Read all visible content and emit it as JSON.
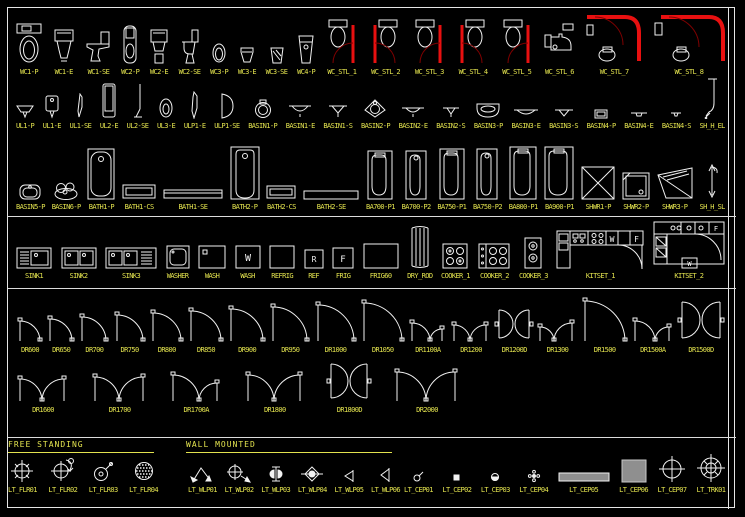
{
  "palette": {
    "background": "#000000",
    "line_color": "#f2f2f2",
    "label_color": "#e2e24e",
    "red": "#e81010",
    "dark_red": "#7e0000",
    "gray_fill": "#8f8f8f"
  },
  "sections": {
    "free_standing": "FREE STANDING",
    "wall_mounted": "WALL MOUNTED"
  },
  "glyph_letters": {
    "w": "W",
    "f": "F",
    "r": "R"
  },
  "rows": [
    {
      "id": "wc",
      "items": [
        {
          "label": "WC1-P",
          "glyph": "wc_p"
        },
        {
          "label": "WC1-E",
          "glyph": "wc_e"
        },
        {
          "label": "WC1-SE",
          "glyph": "wc_se"
        },
        {
          "label": "WC2-P",
          "glyph": "wc2_p"
        },
        {
          "label": "WC2-E",
          "glyph": "wc2_e"
        },
        {
          "label": "WC2-SE",
          "glyph": "wc2_se"
        },
        {
          "label": "WC3-P",
          "glyph": "wc3_p"
        },
        {
          "label": "WC3-E",
          "glyph": "wc3_e"
        },
        {
          "label": "WC3-SE",
          "glyph": "wc3_se"
        },
        {
          "label": "WC4-P",
          "glyph": "wc4_p"
        },
        {
          "label": "WC_STL_1",
          "glyph": "stl",
          "p": [
            0
          ]
        },
        {
          "label": "WC_STL_2",
          "glyph": "stl",
          "p": [
            1
          ]
        },
        {
          "label": "WC_STL_3",
          "glyph": "stl",
          "p": [
            0
          ]
        },
        {
          "label": "WC_STL_4",
          "glyph": "stl",
          "p": [
            1
          ]
        },
        {
          "label": "WC_STL_5",
          "glyph": "stl",
          "p": [
            0
          ]
        },
        {
          "label": "WC_STL_6",
          "glyph": "stl6"
        },
        {
          "label": "WC_STL_7",
          "glyph": "stl7"
        },
        {
          "label": "WC_STL_8",
          "glyph": "stl8"
        }
      ]
    },
    {
      "id": "urinal-basin",
      "items": [
        {
          "label": "UL1-P",
          "glyph": "ul1p"
        },
        {
          "label": "UL1-E",
          "glyph": "ul1e"
        },
        {
          "label": "UL1-SE",
          "glyph": "ul1se"
        },
        {
          "label": "UL2-E",
          "glyph": "ul2e"
        },
        {
          "label": "UL2-SE",
          "glyph": "ul2se"
        },
        {
          "label": "UL3-E",
          "glyph": "ul3e"
        },
        {
          "label": "ULP1-E",
          "glyph": "ulp1e"
        },
        {
          "label": "ULP1-SE",
          "glyph": "ulp1se"
        },
        {
          "label": "BASIN1-P",
          "glyph": "bs1p"
        },
        {
          "label": "BASIN1-E",
          "glyph": "bs1e"
        },
        {
          "label": "BASIN1-S",
          "glyph": "bs1s"
        },
        {
          "label": "BASIN2-P",
          "glyph": "bs2p"
        },
        {
          "label": "BASIN2-E",
          "glyph": "bs2e"
        },
        {
          "label": "BASIN2-S",
          "glyph": "bs2s"
        },
        {
          "label": "BASIN3-P",
          "glyph": "bs3p"
        },
        {
          "label": "BASIN3-E",
          "glyph": "bs3e"
        },
        {
          "label": "BASIN3-S",
          "glyph": "bs3s"
        },
        {
          "label": "BASIN4-P",
          "glyph": "bs4p"
        },
        {
          "label": "BASIN4-E",
          "glyph": "bs4e"
        },
        {
          "label": "BASIN4-S",
          "glyph": "bs4s"
        },
        {
          "label": "SH_H_EL",
          "glyph": "shhel"
        }
      ]
    },
    {
      "id": "bath",
      "items": [
        {
          "label": "BASIN5-P",
          "glyph": "bs5p"
        },
        {
          "label": "BASIN6-P",
          "glyph": "bs6p"
        },
        {
          "label": "BATH1-P",
          "glyph": "bath1p"
        },
        {
          "label": "BATH1-CS",
          "glyph": "bath1cs"
        },
        {
          "label": "BATH1-SE",
          "glyph": "bath1se"
        },
        {
          "label": "BATH2-P",
          "glyph": "bath2p"
        },
        {
          "label": "BATH2-CS",
          "glyph": "bath2cs"
        },
        {
          "label": "BATH2-SE",
          "glyph": "bath2se"
        },
        {
          "label": "BA700-P1",
          "glyph": "bav",
          "p": [
            26,
            50,
            1
          ]
        },
        {
          "label": "BA700-P2",
          "glyph": "bav",
          "p": [
            22,
            50,
            0
          ]
        },
        {
          "label": "BA750-P1",
          "glyph": "bav",
          "p": [
            26,
            52,
            1
          ]
        },
        {
          "label": "BA750-P2",
          "glyph": "bav",
          "p": [
            22,
            52,
            0
          ]
        },
        {
          "label": "BA800-P1",
          "glyph": "bav",
          "p": [
            28,
            54,
            1
          ]
        },
        {
          "label": "BA900-P1",
          "glyph": "bav",
          "p": [
            30,
            54,
            1
          ]
        },
        {
          "label": "SHWR1-P",
          "glyph": "shwr1"
        },
        {
          "label": "SHWR2-P",
          "glyph": "shwr2"
        },
        {
          "label": "SHWR3-P",
          "glyph": "shwr3"
        },
        {
          "label": "SH_H_SL",
          "glyph": "shhsl"
        }
      ]
    },
    {
      "id": "kitchen",
      "items": [
        {
          "label": "SINK1",
          "glyph": "sink1"
        },
        {
          "label": "SINK2",
          "glyph": "sink2"
        },
        {
          "label": "SINK3",
          "glyph": "sink3"
        },
        {
          "label": "WASHER",
          "glyph": "washer"
        },
        {
          "label": "WASH",
          "glyph": "wash1"
        },
        {
          "label": "WASH",
          "glyph": "wash2"
        },
        {
          "label": "REFRIG",
          "glyph": "refrig"
        },
        {
          "label": "REF",
          "glyph": "ref"
        },
        {
          "label": "FRIG",
          "glyph": "frig"
        },
        {
          "label": "FRIG60",
          "glyph": "frig60"
        },
        {
          "label": "DRY_ROD",
          "glyph": "dryrod"
        },
        {
          "label": "COOKER_1",
          "glyph": "cook1"
        },
        {
          "label": "COOKER_2",
          "glyph": "cook2"
        },
        {
          "label": "COOKER_3",
          "glyph": "cook3"
        },
        {
          "label": "KITSET_1",
          "glyph": "kit1"
        },
        {
          "label": "KITSET_2",
          "glyph": "kit2"
        }
      ]
    },
    {
      "id": "doors1",
      "items": [
        {
          "label": "DR600",
          "glyph": "door",
          "p": [
            20
          ]
        },
        {
          "label": "DR650",
          "glyph": "door",
          "p": [
            22
          ]
        },
        {
          "label": "DR700",
          "glyph": "door",
          "p": [
            24
          ]
        },
        {
          "label": "DR750",
          "glyph": "door",
          "p": [
            26
          ]
        },
        {
          "label": "DR800",
          "glyph": "door",
          "p": [
            28
          ]
        },
        {
          "label": "DR850",
          "glyph": "door",
          "p": [
            30
          ]
        },
        {
          "label": "DR900",
          "glyph": "door",
          "p": [
            32
          ]
        },
        {
          "label": "DR950",
          "glyph": "door",
          "p": [
            34
          ]
        },
        {
          "label": "DR1000",
          "glyph": "door",
          "p": [
            36
          ]
        },
        {
          "label": "DR1050",
          "glyph": "door",
          "p": [
            38
          ]
        },
        {
          "label": "DR1100A",
          "glyph": "doorm",
          "p": [
            18,
            12
          ]
        },
        {
          "label": "DR1200",
          "glyph": "doorm",
          "p": [
            16,
            16
          ]
        },
        {
          "label": "DR1200D",
          "glyph": "doord",
          "p": [
            14
          ]
        },
        {
          "label": "DR1300",
          "glyph": "doorm",
          "p": [
            14,
            18
          ]
        },
        {
          "label": "DR1500",
          "glyph": "door",
          "p": [
            40
          ]
        },
        {
          "label": "DR1500A",
          "glyph": "doorm",
          "p": [
            20,
            14
          ]
        },
        {
          "label": "DR1500D",
          "glyph": "doord",
          "p": [
            18
          ]
        }
      ]
    },
    {
      "id": "doors2",
      "items": [
        {
          "label": "DR1600",
          "glyph": "doorm",
          "p": [
            22,
            22
          ]
        },
        {
          "label": "DR1700",
          "glyph": "doorm",
          "p": [
            24,
            24
          ]
        },
        {
          "label": "DR1700A",
          "glyph": "doorm",
          "p": [
            26,
            18
          ]
        },
        {
          "label": "DR1800",
          "glyph": "doorm",
          "p": [
            26,
            26
          ]
        },
        {
          "label": "DR1800D",
          "glyph": "doord",
          "p": [
            17
          ]
        },
        {
          "label": "DR2000",
          "glyph": "doorm",
          "p": [
            29,
            29
          ]
        }
      ]
    },
    {
      "id": "lt-free",
      "items": [
        {
          "label": "LT_FLR01",
          "glyph": "flr1"
        },
        {
          "label": "LT_FLR02",
          "glyph": "flr2"
        },
        {
          "label": "LT_FLR03",
          "glyph": "flr3"
        },
        {
          "label": "LT_FLR04",
          "glyph": "flr4"
        }
      ]
    },
    {
      "id": "lt-wall",
      "items": [
        {
          "label": "LT_WLP01",
          "glyph": "wlp1"
        },
        {
          "label": "LT_WLP02",
          "glyph": "wlp2"
        },
        {
          "label": "LT_WLP03",
          "glyph": "wlp3"
        },
        {
          "label": "LT_WLP04",
          "glyph": "wlp4"
        },
        {
          "label": "LT_WLP05",
          "glyph": "wlp5"
        },
        {
          "label": "LT_WLP06",
          "glyph": "wlp6"
        }
      ]
    },
    {
      "id": "lt-ceil",
      "items": [
        {
          "label": "LT_CEP01",
          "glyph": "cep1"
        },
        {
          "label": "LT_CEP02",
          "glyph": "cep2"
        },
        {
          "label": "LT_CEP03",
          "glyph": "cep3"
        },
        {
          "label": "LT_CEP04",
          "glyph": "cep4"
        },
        {
          "label": "LT_CEP05",
          "glyph": "cep5"
        },
        {
          "label": "LT_CEP06",
          "glyph": "cep6"
        },
        {
          "label": "LT_CEP07",
          "glyph": "cep7"
        },
        {
          "label": "LT_TRK01",
          "glyph": "trk1"
        }
      ]
    }
  ]
}
